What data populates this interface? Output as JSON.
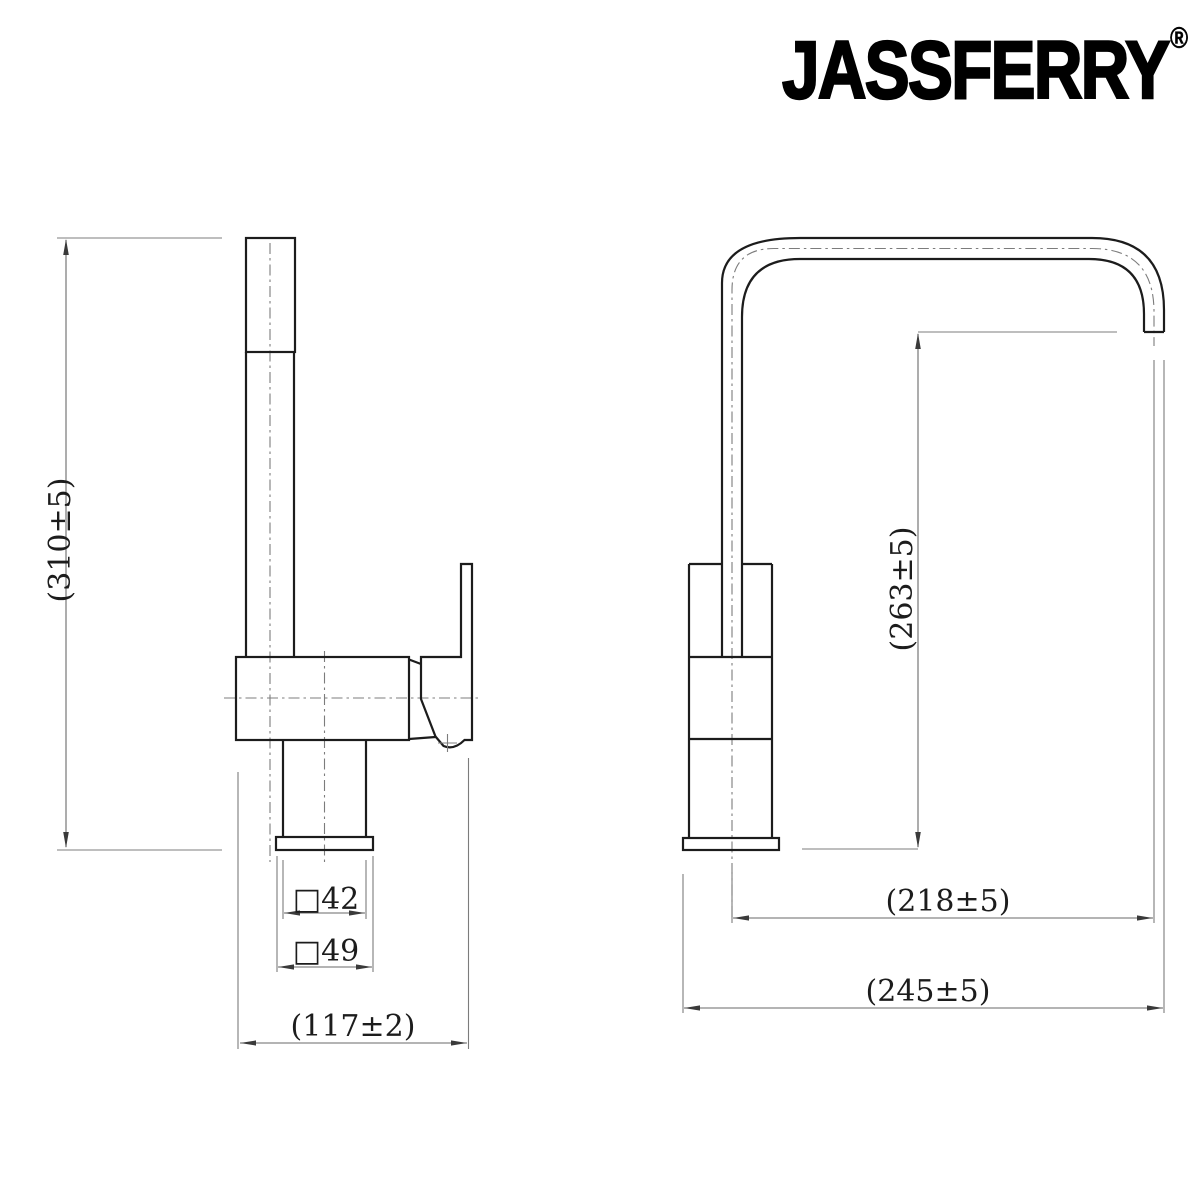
{
  "brand": {
    "logo_text": "JASSFERRY",
    "registered_mark": "®"
  },
  "drawing": {
    "side_view": {
      "overall_height": "(310±5)",
      "base_square": "□42",
      "flange_square": "□49",
      "depth": "(117±2)"
    },
    "front_view": {
      "outlet_height": "(263±5)",
      "spout_reach": "(218±5)",
      "overall_width": "(245±5)"
    }
  },
  "colors": {
    "background": "#ffffff",
    "object_line": "#1c1c1c",
    "thin_line": "#777777",
    "text": "#1c1c1c"
  }
}
